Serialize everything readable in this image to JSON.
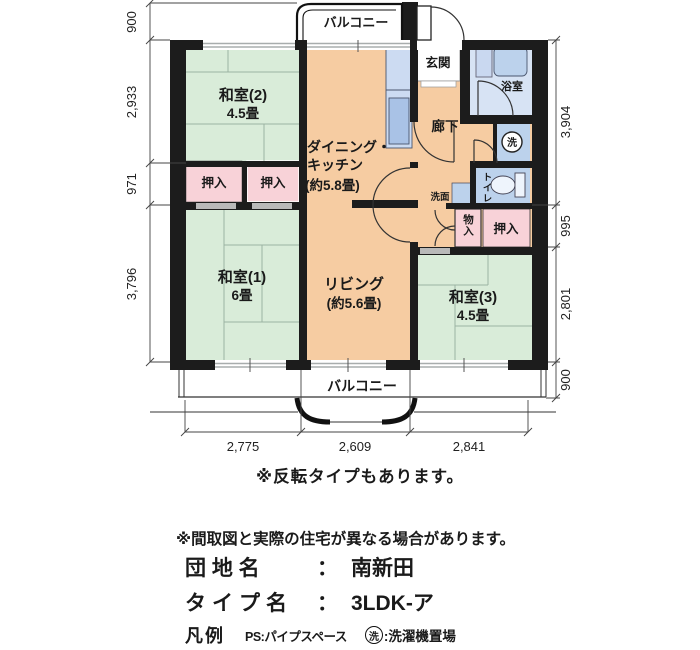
{
  "plan": {
    "balcony_top_label": "バルコニー",
    "balcony_bottom_label": "バルコニー",
    "rooms": {
      "washitsu2": {
        "name": "和室(2)",
        "size": "4.5畳"
      },
      "dk": {
        "name_line1": "ダイニング・",
        "name_line2": "キッチン",
        "size": "(約5.8畳)"
      },
      "washitsu1": {
        "name": "和室(1)",
        "size": "6畳"
      },
      "living": {
        "name": "リビング",
        "size": "(約5.6畳)"
      },
      "washitsu3": {
        "name": "和室(3)",
        "size": "4.5畳"
      },
      "genkan": "玄関",
      "bathroom": "浴室",
      "hallway": "廊下",
      "toilet": "トイレ",
      "washstand": "洗面",
      "laundry_symbol": "洗",
      "closet_top_left": "押入",
      "closet_top_right": "押入",
      "closet_right": "押入",
      "storage": "物入"
    },
    "dimensions": {
      "left": [
        "900",
        "2,933",
        "971",
        "3,796"
      ],
      "right": [
        "3,904",
        "995",
        "2,801",
        "900"
      ],
      "bottom": [
        "2,775",
        "2,609",
        "2,841"
      ]
    }
  },
  "notes": {
    "reverse_type": "※反転タイプもあります。",
    "disclaimer": "※間取図と実際の住宅が異なる場合があります。"
  },
  "info": {
    "estate_label": "団 地 名",
    "colon": "：",
    "estate_value": "南新田",
    "type_label": "タイプ名",
    "type_value": "3LDK-ア"
  },
  "legend": {
    "title": "凡例",
    "ps_text": "PS:パイプスペース",
    "laundry_mark": "洗",
    "laundry_text": ":洗濯機置場"
  },
  "colors": {
    "wall": "#1c1c1c",
    "tatami_green": "#d9ecd9",
    "floor_orange": "#f6cca2",
    "closet_pink": "#f8d2d8",
    "fixture_blue": "#bcd2ec",
    "bath_floor_blue": "#d7e3f4"
  }
}
